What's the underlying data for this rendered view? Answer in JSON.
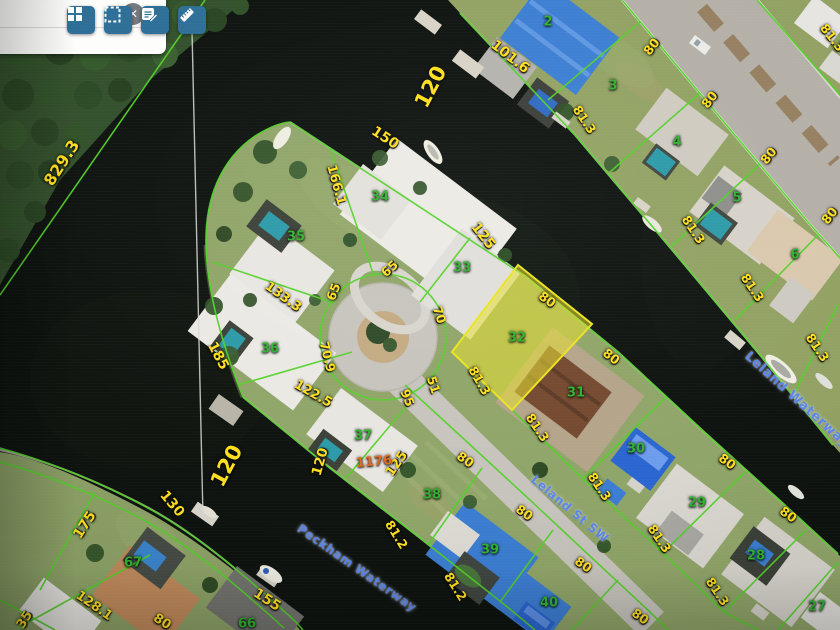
{
  "toolbar": {
    "search": {
      "placeholder": "",
      "value": "",
      "close_glyph": "✕",
      "close_icon": "close-icon"
    },
    "buttons": [
      {
        "icon": "grid-icon"
      },
      {
        "icon": "marquee-select-icon"
      },
      {
        "icon": "note-edit-icon"
      },
      {
        "icon": "ruler-icon"
      }
    ]
  },
  "map": {
    "selected_parcel": {
      "lot": "32"
    },
    "colors": {
      "parcel_line": "#54d12a",
      "dimension_text": "#ffdf1f",
      "lot_text": "#2fb32f",
      "street_text": "#5b86e8",
      "address_text": "#e06a1f",
      "highlight_fill": "#e6df2e",
      "button_blue": "#2e6f97"
    },
    "lot_numbers": [
      {
        "t": "2",
        "x": 548,
        "y": 22
      },
      {
        "t": "3",
        "x": 613,
        "y": 86
      },
      {
        "t": "4",
        "x": 677,
        "y": 142
      },
      {
        "t": "5",
        "x": 737,
        "y": 198
      },
      {
        "t": "6",
        "x": 795,
        "y": 255
      },
      {
        "t": "27",
        "x": 817,
        "y": 607
      },
      {
        "t": "28",
        "x": 756,
        "y": 556
      },
      {
        "t": "29",
        "x": 697,
        "y": 503
      },
      {
        "t": "30",
        "x": 636,
        "y": 449
      },
      {
        "t": "31",
        "x": 576,
        "y": 393
      },
      {
        "t": "32",
        "x": 517,
        "y": 338
      },
      {
        "t": "33",
        "x": 462,
        "y": 268
      },
      {
        "t": "34",
        "x": 380,
        "y": 197
      },
      {
        "t": "35",
        "x": 296,
        "y": 237
      },
      {
        "t": "36",
        "x": 270,
        "y": 349
      },
      {
        "t": "37",
        "x": 363,
        "y": 436
      },
      {
        "t": "38",
        "x": 432,
        "y": 495
      },
      {
        "t": "39",
        "x": 490,
        "y": 550
      },
      {
        "t": "40",
        "x": 549,
        "y": 603
      },
      {
        "t": "66",
        "x": 247,
        "y": 624
      },
      {
        "t": "67",
        "x": 133,
        "y": 563
      }
    ],
    "dimensions": [
      {
        "t": "829.3",
        "x": 62,
        "y": 163,
        "r": -57,
        "s": 16
      },
      {
        "t": "120",
        "x": 431,
        "y": 87,
        "r": -62,
        "s": 21
      },
      {
        "t": "101.6",
        "x": 510,
        "y": 57,
        "r": 38,
        "s": 14
      },
      {
        "t": "80",
        "x": 652,
        "y": 47,
        "r": -52
      },
      {
        "t": "81.3",
        "x": 832,
        "y": 38,
        "r": 52
      },
      {
        "t": "81.3",
        "x": 584,
        "y": 120,
        "r": 56
      },
      {
        "t": "80",
        "x": 710,
        "y": 100,
        "r": -52
      },
      {
        "t": "80",
        "x": 769,
        "y": 156,
        "r": -52
      },
      {
        "t": "80",
        "x": 830,
        "y": 216,
        "r": -52
      },
      {
        "t": "81.3",
        "x": 693,
        "y": 230,
        "r": 56
      },
      {
        "t": "81.3",
        "x": 752,
        "y": 288,
        "r": 56
      },
      {
        "t": "81.3",
        "x": 817,
        "y": 348,
        "r": 56
      },
      {
        "t": "150",
        "x": 385,
        "y": 138,
        "r": 33,
        "s": 14
      },
      {
        "t": "166.1",
        "x": 336,
        "y": 185,
        "r": 75,
        "s": 13
      },
      {
        "t": "125",
        "x": 483,
        "y": 236,
        "r": 52,
        "s": 14
      },
      {
        "t": "65",
        "x": 390,
        "y": 269,
        "r": -42
      },
      {
        "t": "65",
        "x": 334,
        "y": 292,
        "r": -68
      },
      {
        "t": "70",
        "x": 439,
        "y": 315,
        "r": 72
      },
      {
        "t": "133.3",
        "x": 283,
        "y": 297,
        "r": 36,
        "s": 13
      },
      {
        "t": "185",
        "x": 218,
        "y": 356,
        "r": 62,
        "s": 14
      },
      {
        "t": "70.9",
        "x": 327,
        "y": 357,
        "r": 76
      },
      {
        "t": "122.5",
        "x": 313,
        "y": 394,
        "r": 30,
        "s": 13
      },
      {
        "t": "95",
        "x": 407,
        "y": 398,
        "r": 68
      },
      {
        "t": "51",
        "x": 433,
        "y": 385,
        "r": 72
      },
      {
        "t": "80",
        "x": 547,
        "y": 300,
        "r": 36
      },
      {
        "t": "81.3",
        "x": 479,
        "y": 381,
        "r": 60
      },
      {
        "t": "80",
        "x": 611,
        "y": 357,
        "r": 38
      },
      {
        "t": "81.3",
        "x": 537,
        "y": 428,
        "r": 56
      },
      {
        "t": "81.3",
        "x": 599,
        "y": 487,
        "r": 56
      },
      {
        "t": "80",
        "x": 727,
        "y": 462,
        "r": 36
      },
      {
        "t": "80",
        "x": 788,
        "y": 515,
        "r": 36
      },
      {
        "t": "81.3",
        "x": 659,
        "y": 539,
        "r": 56
      },
      {
        "t": "81.3",
        "x": 717,
        "y": 592,
        "r": 56
      },
      {
        "t": "80",
        "x": 640,
        "y": 617,
        "r": 36
      },
      {
        "t": "125",
        "x": 397,
        "y": 464,
        "r": -55,
        "s": 13
      },
      {
        "t": "80",
        "x": 465,
        "y": 460,
        "r": 35
      },
      {
        "t": "81.2",
        "x": 396,
        "y": 535,
        "r": 58
      },
      {
        "t": "81.2",
        "x": 455,
        "y": 587,
        "r": 58
      },
      {
        "t": "80",
        "x": 524,
        "y": 513,
        "r": 35
      },
      {
        "t": "80",
        "x": 583,
        "y": 565,
        "r": 35
      },
      {
        "t": "120",
        "x": 227,
        "y": 466,
        "r": -62,
        "s": 21
      },
      {
        "t": "120",
        "x": 321,
        "y": 462,
        "r": -74,
        "s": 13.5
      },
      {
        "t": "130",
        "x": 172,
        "y": 504,
        "r": 50,
        "s": 14
      },
      {
        "t": "175",
        "x": 85,
        "y": 525,
        "r": -57,
        "s": 14
      },
      {
        "t": "128.1",
        "x": 94,
        "y": 606,
        "r": 35,
        "s": 13
      },
      {
        "t": "35",
        "x": 25,
        "y": 620,
        "r": -57,
        "s": 13
      },
      {
        "t": "155",
        "x": 267,
        "y": 600,
        "r": 33,
        "s": 14
      },
      {
        "t": "80",
        "x": 162,
        "y": 622,
        "r": 33,
        "s": 13
      }
    ],
    "streets": [
      {
        "t": "Leland Waterway",
        "x": 797,
        "y": 400,
        "r": 42,
        "s": 13
      },
      {
        "t": "Leland St SW",
        "x": 570,
        "y": 509,
        "r": 40,
        "s": 12
      },
      {
        "t": "Peckham Waterway",
        "x": 357,
        "y": 568,
        "r": 35,
        "s": 12
      }
    ],
    "addresses": [
      {
        "t": "1176",
        "x": 374,
        "y": 462,
        "r": -5
      }
    ]
  }
}
